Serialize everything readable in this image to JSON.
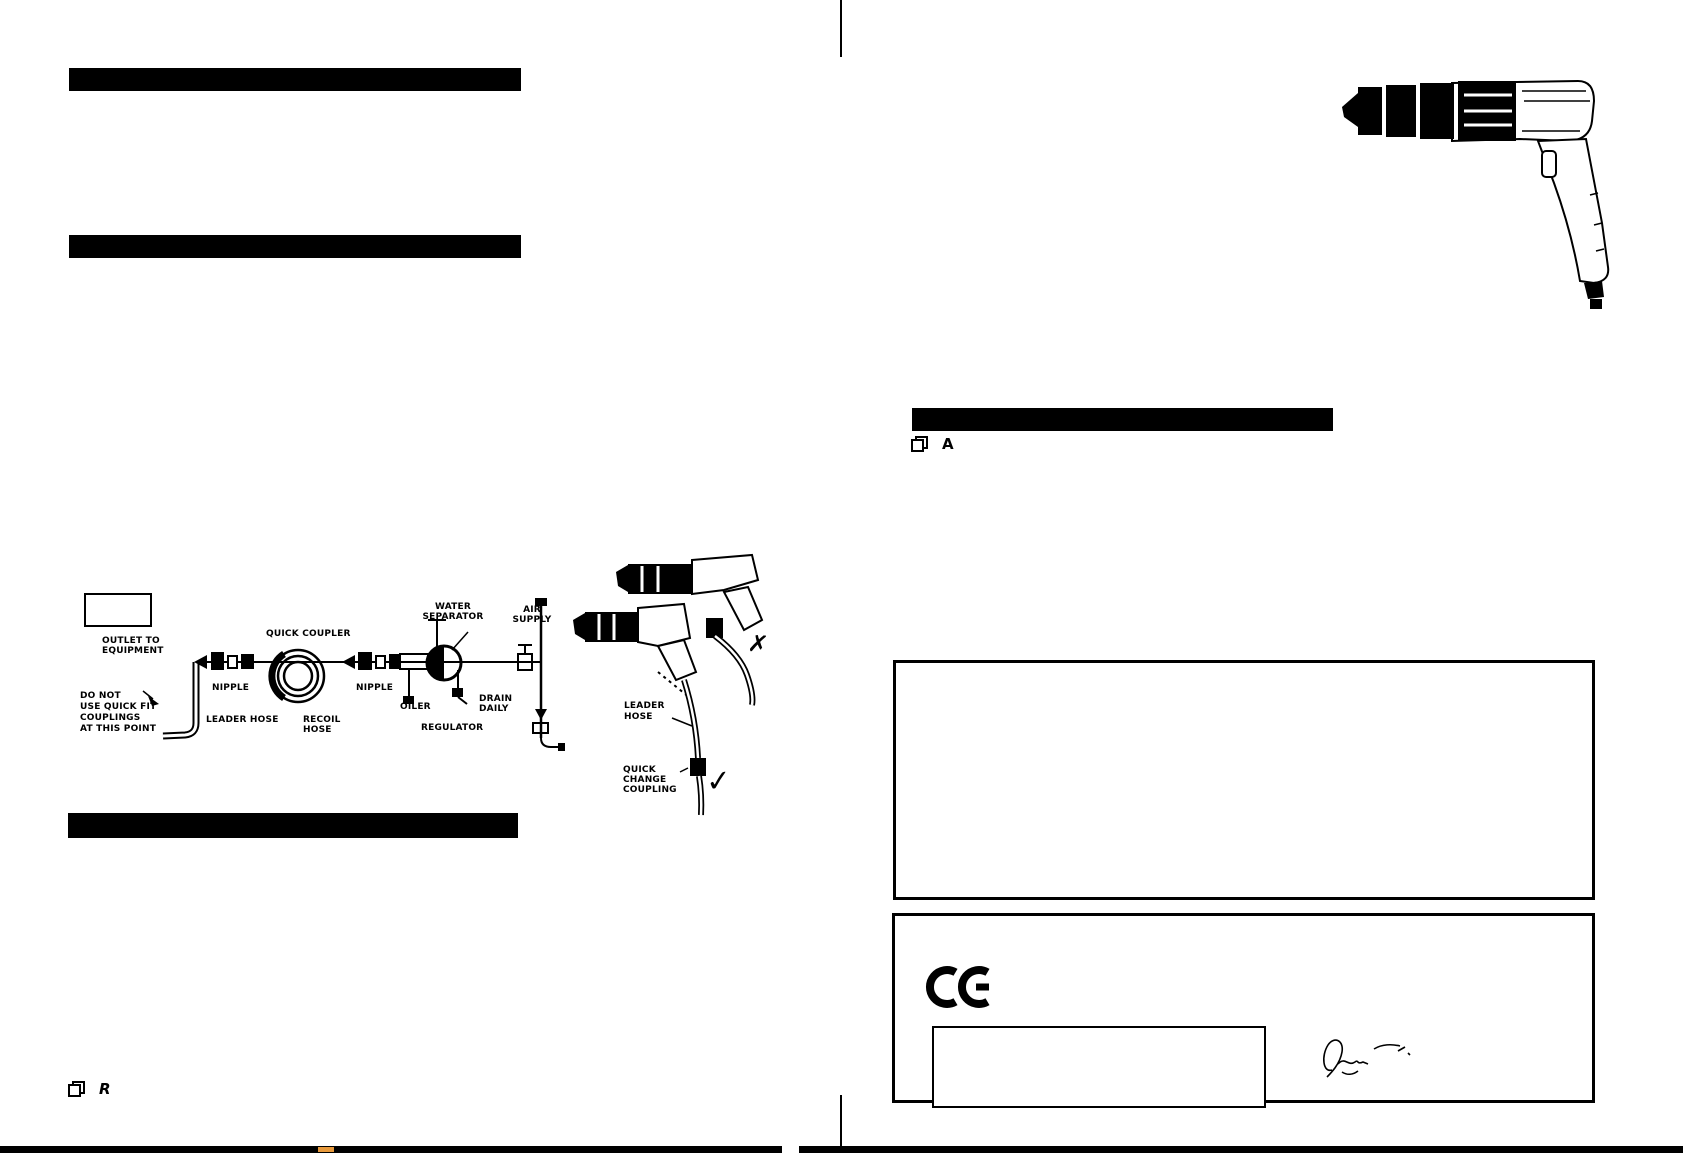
{
  "colors": {
    "ink": "#000000",
    "paper": "#ffffff",
    "artifact_orange": "#e89a3c"
  },
  "left_page": {
    "figure_ref": {
      "label": "R"
    },
    "diagram": {
      "labels": {
        "outlet": "OUTLET TO\nEQUIPMENT",
        "no_quick_fit": "DO NOT\nUSE QUICK FIT\nCOUPLINGS\nAT THIS POINT",
        "quick_coupler": "QUICK COUPLER",
        "nipple_left": "NIPPLE",
        "leader_hose": "LEADER HOSE",
        "recoil_hose": "RECOIL\nHOSE",
        "nipple_right": "NIPPLE",
        "oiler": "OILER",
        "regulator": "REGULATOR",
        "drain_daily": "DRAIN\nDAILY",
        "water_separator": "WATER\nSEPARATOR",
        "air_supply": "AIR\nSUPPLY"
      },
      "connection": {
        "leader_hose": "LEADER\nHOSE",
        "quick_change_coupling": "QUICK\nCHANGE\nCOUPLING",
        "wrong_mark": "✗",
        "correct_mark": "✓"
      }
    }
  },
  "right_page": {
    "figure_ref": {
      "label": "A"
    },
    "ce_mark": {
      "text": "CE"
    }
  }
}
